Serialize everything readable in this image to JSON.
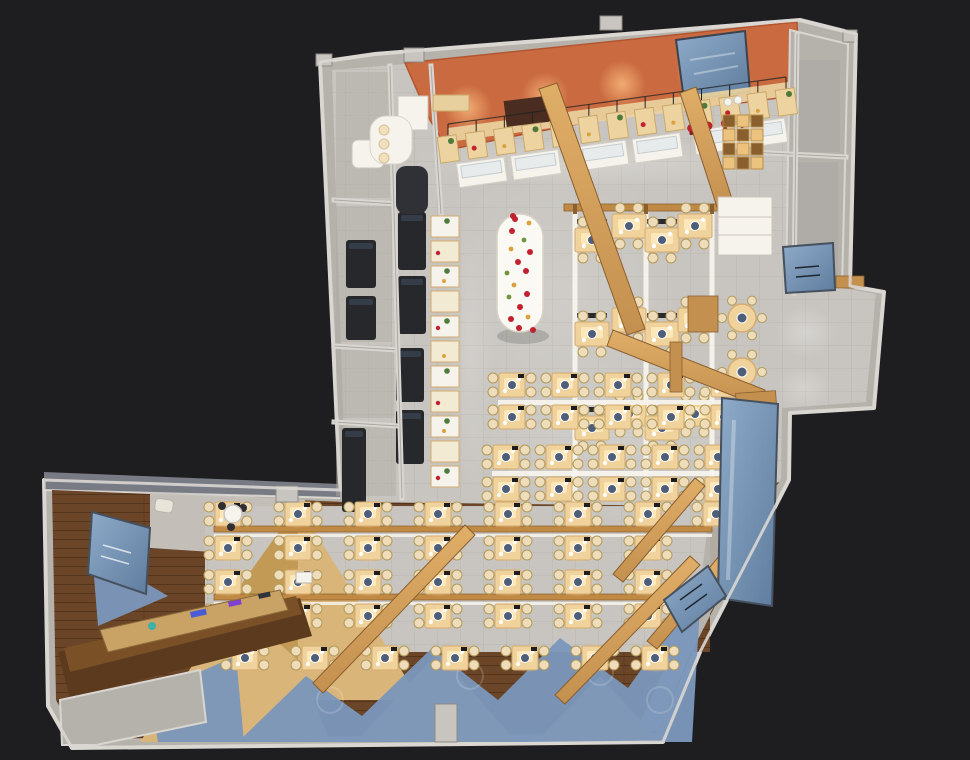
{
  "scene": {
    "description": "photorealistic 3D top-down render of an L-shaped restaurant / canteen floor plan on a dark backdrop",
    "background": "#1e1e20"
  },
  "palette": {
    "bg": "#1e1e20",
    "wallFace": "#b5b1ab",
    "wallTop": "#d9d6d1",
    "wallShadow": "#8e8a84",
    "wallBand": "#787b83",
    "tile": "#c8c5c0",
    "tileLine": "rgba(110,104,96,0.16)",
    "roomShade": "#aeaaa4",
    "woodFloor": "#6b4527",
    "plankLine": "rgba(40,22,8,0.35)",
    "woodLight": "#d9b579",
    "woodLightHi": "#e9cf97",
    "beam": "#c4904f",
    "beamHi": "#dfae67",
    "beamStroke": "#8a5f2e",
    "railWood": "#c08a45",
    "white": "#f6f3ec",
    "counterGlass": "#e7ebec",
    "tableWood": "#f0d29c",
    "tableHi": "#ffe9bd",
    "tableStroke": "#d3ab6e",
    "chair": "#eedcba",
    "chairStroke": "#b09a58",
    "plate": "#4e5e79",
    "benchDark": "#2a2a2e",
    "equip": "#26282c",
    "equipHi": "#3a4450",
    "orange": "#c96a40",
    "orangeDeep": "#b2562f",
    "blue": "#6d8cb3",
    "blueStroke": "#46515f",
    "blueFloor": "#7b97ba",
    "red": "#c32030",
    "redDark": "#8e1420",
    "green": "#4e7a3a",
    "cream": "#f3ead4",
    "hood": "#4a2c20",
    "darkCounter": "#5b3a1e",
    "darkCounterHi": "#7a5026",
    "tray": "#c9a365"
  },
  "layout": {
    "silhouette": "320,62 375,54 800,20 856,34 850,286 884,292 874,408 790,413 789,480 700,652 663,742 72,748 48,706 44,480 340,490",
    "interior": "332,70 796,32 848,44 842,288 876,294 866,402 782,408 781,478 693,646 657,734 78,740 56,700 52,490 346,502 332,70",
    "wingWoodOuter": "52,490 346,502 700,506 779,482 695,645 658,733 78,739 56,700",
    "wingWoodHole": "205,506 710,506 710,652 205,652",
    "walkway": "710,506 779,484 694,644 658,732 636,732 700,590",
    "entrancePatch": "150,492 305,500 305,558 150,548",
    "wingWallBand": "44,472 340,484 340,498 44,490",
    "orangeCanopy": "405,63 797,22 800,95 740,103 640,112 520,135 448,150 430,120",
    "skylight": "676,40 745,31 750,92 684,100",
    "roomsTopRight": "790,30 848,44 842,288 786,292",
    "roomRects": [
      [
        796,
        60,
        44,
        92
      ],
      [
        796,
        162,
        42,
        118
      ]
    ],
    "wingRoomShades": [
      [
        336,
        72,
        54,
        126
      ],
      [
        336,
        206,
        56,
        136
      ],
      [
        336,
        350,
        58,
        68
      ],
      [
        336,
        424,
        60,
        72
      ]
    ],
    "dividers": [
      [
        334,
        200,
        398,
        204
      ],
      [
        334,
        346,
        398,
        350
      ],
      [
        334,
        422,
        398,
        426
      ],
      [
        390,
        66,
        402,
        498
      ],
      [
        431,
        66,
        441,
        214
      ],
      [
        750,
        152,
        846,
        157
      ],
      [
        797,
        34,
        794,
        293
      ]
    ],
    "pillars": [
      [
        404,
        48,
        20,
        14
      ],
      [
        600,
        16,
        22,
        14
      ],
      [
        316,
        54,
        16,
        12
      ],
      [
        843,
        30,
        14,
        12
      ],
      [
        276,
        486,
        22,
        16
      ],
      [
        435,
        704,
        22,
        38
      ]
    ],
    "wedges": [
      "140,742 262,564 330,742",
      "356,742 438,652 516,742",
      "536,742 600,676 660,742",
      "298,505 420,700 298,700",
      "298,505 230,600 298,660"
    ],
    "blueFloorShapes": [
      "238,742 306,676 362,716 432,648 498,700 560,638 628,688 662,640 700,606 692,742",
      "92,552 168,596 98,626",
      "150,694 236,656 244,742 158,742"
    ],
    "lightSpots": [
      [
        600,
        162,
        190,
        26,
        0.22
      ],
      [
        560,
        300,
        120,
        150,
        0.13
      ],
      [
        610,
        440,
        170,
        80,
        0.15
      ],
      [
        470,
        350,
        26,
        130,
        0.15
      ],
      [
        806,
        332,
        30,
        26,
        0.25
      ],
      [
        804,
        388,
        28,
        22,
        0.22
      ]
    ],
    "orangeGlowSpots": [
      [
        468,
        108
      ],
      [
        545,
        96
      ],
      [
        622,
        84
      ],
      [
        700,
        72
      ]
    ]
  },
  "furniture": {
    "buffet": {
      "line": {
        "x1": 448,
        "y1": 150,
        "x2": 786,
        "y2": 103
      },
      "boardCount": 13,
      "counterTs": [
        0.1,
        0.26,
        0.46,
        0.62,
        0.8,
        0.93
      ],
      "roastTs": [
        0.72,
        0.77,
        0.82,
        0.87
      ],
      "backBar": "448,128 788,82 788,96 448,142",
      "hood": [
        505,
        98,
        50,
        26,
        -7
      ],
      "curvedCounter": [
        370,
        116,
        42,
        48
      ],
      "darkStation": [
        396,
        166,
        32,
        48
      ],
      "topCabinet": [
        433,
        95,
        36,
        16
      ]
    },
    "serviceLine": {
      "x": 431,
      "yStart": 216,
      "yEnd": 486,
      "step": 25,
      "w": 28
    },
    "kitchen": {
      "equipment": [
        [
          346,
          240,
          30,
          48
        ],
        [
          346,
          296,
          30,
          44
        ],
        [
          398,
          212,
          28,
          58
        ],
        [
          398,
          276,
          28,
          58
        ],
        [
          396,
          348,
          28,
          54
        ],
        [
          396,
          410,
          28,
          54
        ],
        [
          342,
          428,
          24,
          84
        ]
      ],
      "whiteBox": [
        398,
        96,
        30,
        34
      ],
      "restroomFixture": [
        352,
        140,
        32,
        28
      ]
    },
    "ovalTable": {
      "x1": 497,
      "x2": 543,
      "yTop": 237,
      "yBot": 309,
      "r": 23,
      "dots": [
        [
          515,
          219,
          0
        ],
        [
          529,
          223,
          1
        ],
        [
          512,
          231,
          0
        ],
        [
          524,
          240,
          2
        ],
        [
          530,
          252,
          0
        ],
        [
          511,
          249,
          1
        ],
        [
          518,
          262,
          0
        ],
        [
          507,
          273,
          2
        ],
        [
          526,
          271,
          0
        ],
        [
          514,
          285,
          1
        ],
        [
          527,
          294,
          0
        ],
        [
          509,
          297,
          2
        ],
        [
          520,
          307,
          0
        ],
        [
          528,
          317,
          1
        ],
        [
          511,
          319,
          0
        ],
        [
          519,
          328,
          0
        ],
        [
          513,
          216,
          0
        ],
        [
          533,
          330,
          0
        ]
      ]
    },
    "booths": {
      "rails": {
        "xs": [
          575,
          646,
          712
        ],
        "y1": 212,
        "y2": 506
      },
      "header": [
        564,
        204,
        166,
        7
      ],
      "cols": [
        {
          "cx": 592,
          "rows": [
            240,
            334,
            428
          ],
          "bench": true
        },
        {
          "cx": 629,
          "rows": [
            226,
            320,
            414
          ],
          "bench": false
        },
        {
          "cx": 662,
          "rows": [
            240,
            334,
            428
          ],
          "bench": true
        },
        {
          "cx": 695,
          "rows": [
            226,
            320,
            414
          ],
          "bench": false
        }
      ]
    },
    "midRows": {
      "whiteRails": [
        [
          498,
          400,
          246
        ],
        [
          492,
          471,
          246
        ]
      ],
      "rows": [
        {
          "y": 385,
          "xs": [
            512,
            565,
            618,
            671,
            724
          ]
        },
        {
          "y": 417,
          "xs": [
            512,
            565,
            618,
            671,
            724
          ]
        },
        {
          "y": 457,
          "xs": [
            506,
            559,
            612,
            665,
            718
          ]
        },
        {
          "y": 489,
          "xs": [
            506,
            559,
            612,
            665,
            718
          ]
        }
      ]
    },
    "lowerRows": {
      "woodRails": [
        [
          214,
          526,
          498
        ],
        [
          214,
          594,
          498
        ]
      ],
      "rows": [
        {
          "y": 514,
          "xs": [
            228,
            298,
            368,
            438,
            508,
            578,
            648,
            716
          ]
        },
        {
          "y": 548,
          "xs": [
            228,
            298,
            368,
            438,
            508,
            578,
            648
          ]
        },
        {
          "y": 582,
          "xs": [
            228,
            298,
            368,
            438,
            508,
            578,
            648
          ]
        },
        {
          "y": 616,
          "xs": [
            228,
            298,
            368,
            438,
            508,
            578,
            648
          ]
        },
        {
          "y": 658,
          "xs": [
            245,
            315,
            385,
            455,
            525,
            595,
            655
          ]
        }
      ]
    },
    "roundTables": [
      [
        742,
        318
      ],
      [
        742,
        372
      ]
    ],
    "beams": [
      "539,89 557,83 645,329 627,335",
      "607,346 613,330 765,390 759,406",
      "680,93 696,87 734,205 718,210",
      "313,683 323,693 475,535 465,525",
      "555,695 565,704 700,565 690,556",
      "613,574 623,582 705,486 695,478",
      "647,641 657,649 731,562 721,554"
    ],
    "woodLedges": [
      [
        736,
        392,
        40,
        13,
        -4
      ],
      [
        742,
        464,
        32,
        12,
        -4
      ],
      [
        670,
        342,
        12,
        50,
        0
      ],
      [
        688,
        296,
        30,
        36,
        0
      ],
      [
        836,
        276,
        28,
        12,
        0
      ]
    ],
    "cubbies": {
      "x": 723,
      "y": 115,
      "cols": 3,
      "rows": 4,
      "cell": 14
    },
    "cabinet": [
      718,
      197,
      54,
      58
    ],
    "dishStack": [
      [
        728,
        102
      ],
      [
        738,
        100
      ]
    ],
    "cashier": {
      "counterDark": "58,652 300,598 312,636 70,698",
      "counterTop": "64,648 296,596 302,614 70,672",
      "tray": "100,630 280,590 288,610 108,652",
      "items": [
        [
          190,
          612,
          16,
          6,
          -12,
          "#4b5bd6"
        ],
        [
          228,
          602,
          13,
          5,
          -12,
          "#7f3fd0"
        ],
        [
          258,
          594,
          12,
          5,
          -12,
          "#30333a"
        ]
      ],
      "tealDot": [
        152,
        626,
        4
      ],
      "register": [
        296,
        572,
        16,
        11
      ],
      "bench": "60,700 200,670 206,722 96,745 62,745"
    },
    "entrance": {
      "table": [
        233,
        514,
        9
      ],
      "chairs": [
        [
          222,
          506
        ],
        [
          243,
          508
        ],
        [
          231,
          527
        ]
      ],
      "armchair": [
        156,
        498,
        18,
        13
      ]
    },
    "bluePanels": {
      "wingBoard": "92,512 150,528 146,594 88,574",
      "door": "783,247 833,243 835,290 786,293",
      "window": "722,398 778,404 772,606 718,598",
      "tv": "664,600 708,566 726,596 682,632"
    }
  }
}
